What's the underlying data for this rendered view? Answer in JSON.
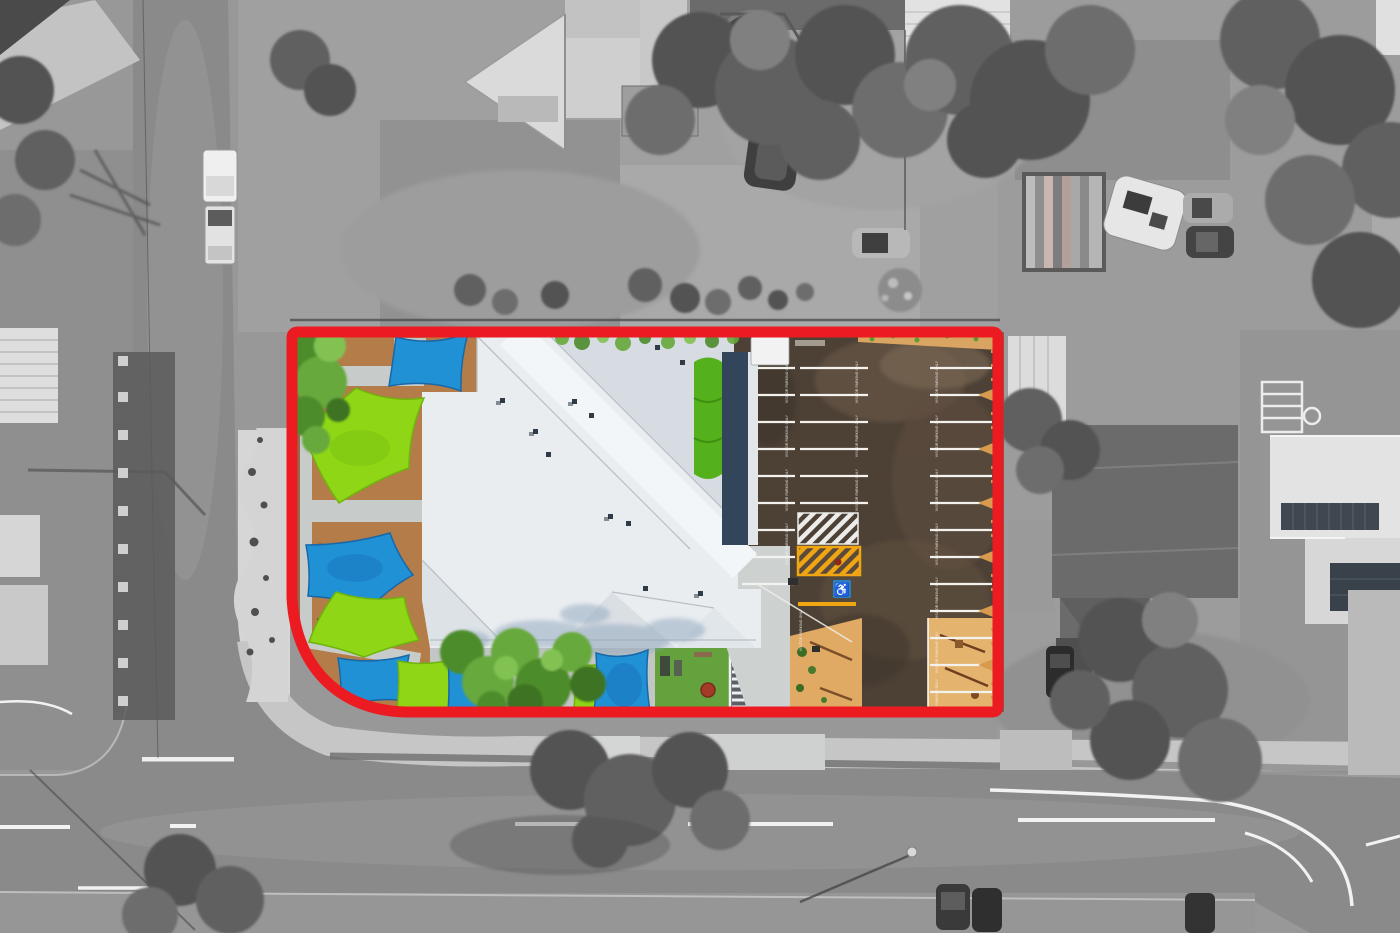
{
  "image": {
    "type": "aerial-drone-photograph",
    "style": "Top-down real-estate aerial photo. Surroundings desaturated to grayscale; subject childcare-centre property shown in full colour inside a thick red boundary with a rounded bottom-left corner."
  },
  "palette": {
    "boundary-red": "#ec1b22",
    "sail-blue": "#2191d6",
    "sail-blue-dark": "#1668a8",
    "sail-green": "#8fd616",
    "sail-green-dark": "#6fb40c",
    "roof-white": "#e9edf0",
    "roof-shade": "#d6dce1",
    "canopy-green": "#54b11c",
    "awning-navy": "#32455a",
    "asphalt-brown": "#4d4136",
    "asphalt-light": "#6e5c4b",
    "mulch-orange": "#b47c48",
    "sand-tan": "#e0aa64",
    "curb-tan": "#d79a4f",
    "lawn-green": "#63a23c",
    "tree-green": "#4d8c2c",
    "hatch-yellow": "#f0a512",
    "disabled-blue": "#2d7fc3",
    "road-gray": "#8a8a8a",
    "path-light": "#c7c7c7"
  },
  "markings": {
    "parking_stencil": "VISITOR PARKING ONLY",
    "road_lines": "white dashed centre lines, give-way bar, curved edge lines at intersections"
  },
  "property": {
    "boundary_shape": "rectangle with large rounded bottom-left corner",
    "contents": [
      "large white metal hip roof building",
      "blue and lime-green shade sails over play areas",
      "orange bark-mulch playgrounds with grey paths",
      "brown asphalt car park with white bay lines and stencilled text",
      "white and yellow hatched pedestrian crossing",
      "accessible parking bay with blue wheelchair marking",
      "tan sand play pockets with timber equipment",
      "green lawn with play items and timber pergola",
      "green shade canopy and navy awning along building edge",
      "colour trees overhanging inside the boundary"
    ]
  },
  "surroundings": [
    "suburban house roofs in grey",
    "round spa pool and sheds",
    "boat on trailer, caravan, parked cars, white ute",
    "two-way road junction with grass verges",
    "large trees and hedges",
    "solar-panel roof house and playground frame"
  ]
}
